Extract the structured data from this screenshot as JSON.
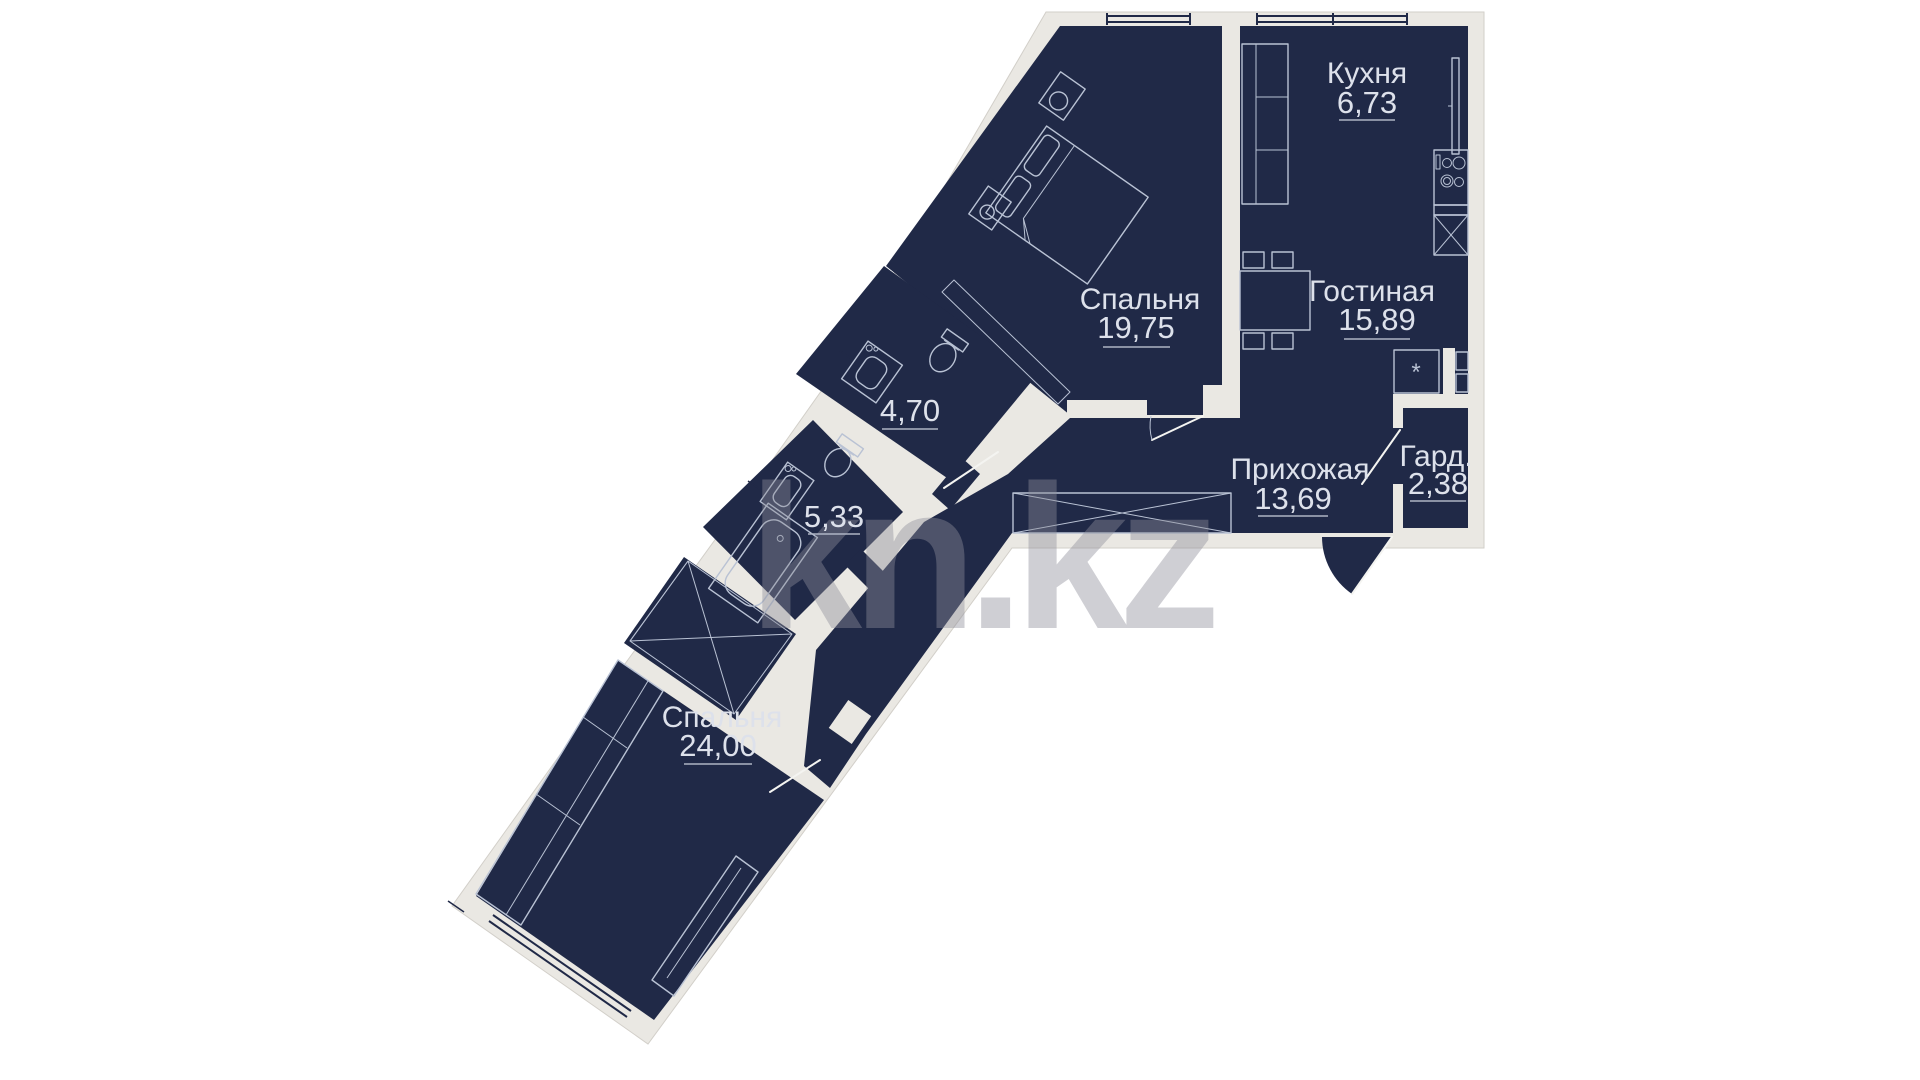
{
  "watermark": {
    "text": "kn.kz"
  },
  "rooms": [
    {
      "id": "kitchen",
      "name": "Кухня",
      "area": "6,73"
    },
    {
      "id": "bedroom-1",
      "name": "Спальня",
      "area": "19,75"
    },
    {
      "id": "living",
      "name": "Гостиная",
      "area": "15,89"
    },
    {
      "id": "hallway",
      "name": "Прихожая",
      "area": "13,69"
    },
    {
      "id": "wardrobe",
      "name": "Гард.",
      "area": "2,38"
    },
    {
      "id": "bathroom-1",
      "name": "",
      "area": "4,70"
    },
    {
      "id": "bathroom-2",
      "name": "",
      "area": "5,33"
    },
    {
      "id": "bedroom-2",
      "name": "Спальня",
      "area": "24,00"
    }
  ],
  "shaft_mark": "*",
  "colors": {
    "floor": "#202947",
    "wall": "#eae8e3",
    "wallEdge": "#d2cfc9",
    "line": "#b9c2d4",
    "label": "#dde1eb",
    "ul": "#aeb4c4",
    "watermark": "#8e8e9a"
  }
}
